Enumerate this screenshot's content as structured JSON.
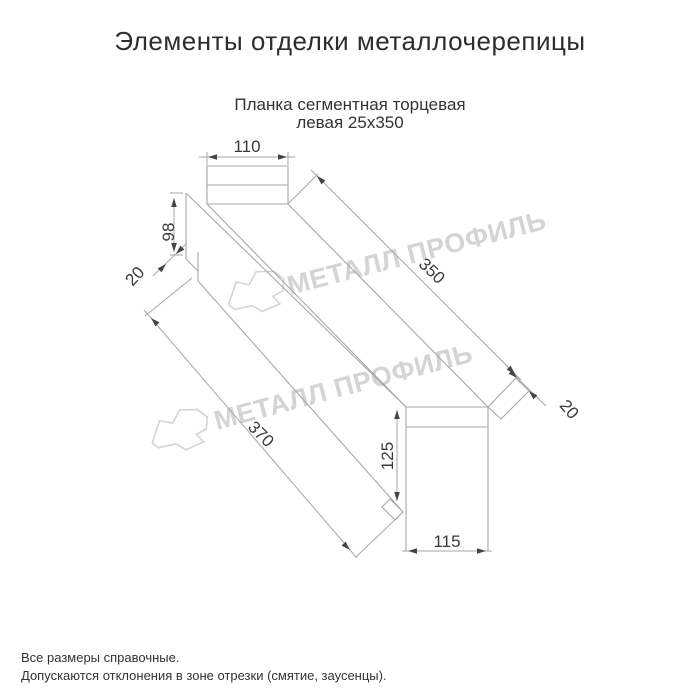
{
  "page": {
    "title": "Элементы отделки металлочерепицы",
    "subtitle": {
      "line1": "Планка сегментная торцевая",
      "line2": "левая 25х350"
    },
    "footer": {
      "line1": "Все размеры справочные.",
      "line2": "Допускаются отклонения в зоне отрезки (смятие, заусенцы)."
    }
  },
  "drawing": {
    "product_name": "Планка сегментная торцевая левая 25х350",
    "dimensions": {
      "top_width": "110",
      "left_end_height": "98",
      "left_fold": "20",
      "top_length": "350",
      "bottom_length": "370",
      "right_fold": "20",
      "right_end_height": "125",
      "right_end_width": "115"
    },
    "watermark": {
      "text": "МЕТАЛЛ ПРОФИЛЬ"
    }
  },
  "colors": {
    "background": "#ffffff",
    "line": "#a7a7ac",
    "dimension_text": "#3a3a3a",
    "arrow": "#444444",
    "title_text": "#2d2d2d",
    "watermark": "#d4d4d4"
  }
}
